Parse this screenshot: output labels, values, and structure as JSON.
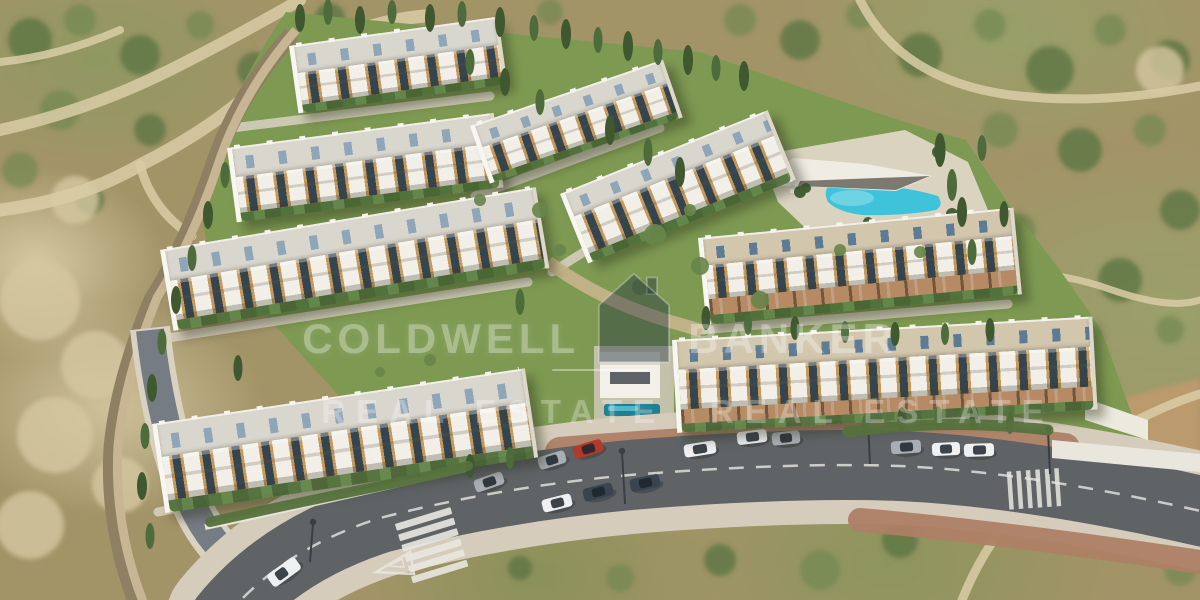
{
  "watermark": {
    "word_left": "COLDWELL",
    "word_right": "BANKER",
    "tagline": "REAL ESTATE",
    "logo_icon": "coldwell-banker-house-icon",
    "text_color": "rgba(255,255,255,0.30)"
  },
  "palette": {
    "hill": "#a39468",
    "lawn": "#7e9a52",
    "asphalt": "#5f6366",
    "sidewalk": "#d6ccbb",
    "paver": "#ad8065",
    "road-line": "#e8e6df",
    "wall": "#c7b593",
    "wall-shadow": "#8f7f63",
    "roof": "#d9d6cd",
    "facade": "#f2efe8",
    "wood": "#c2995e",
    "window": "#36444e",
    "skylight": "#8fa6b8",
    "pool": "#3ec3da",
    "deck": "#ded6c6",
    "car-red": "#b03a2e",
    "car-dark": "#39444e",
    "car-white": "#eef0f1",
    "car-gray": "#a8aeb3",
    "watermark-light": "rgba(255,255,255,0.30)",
    "watermark-dark": "rgba(18,38,58,0.38)"
  }
}
